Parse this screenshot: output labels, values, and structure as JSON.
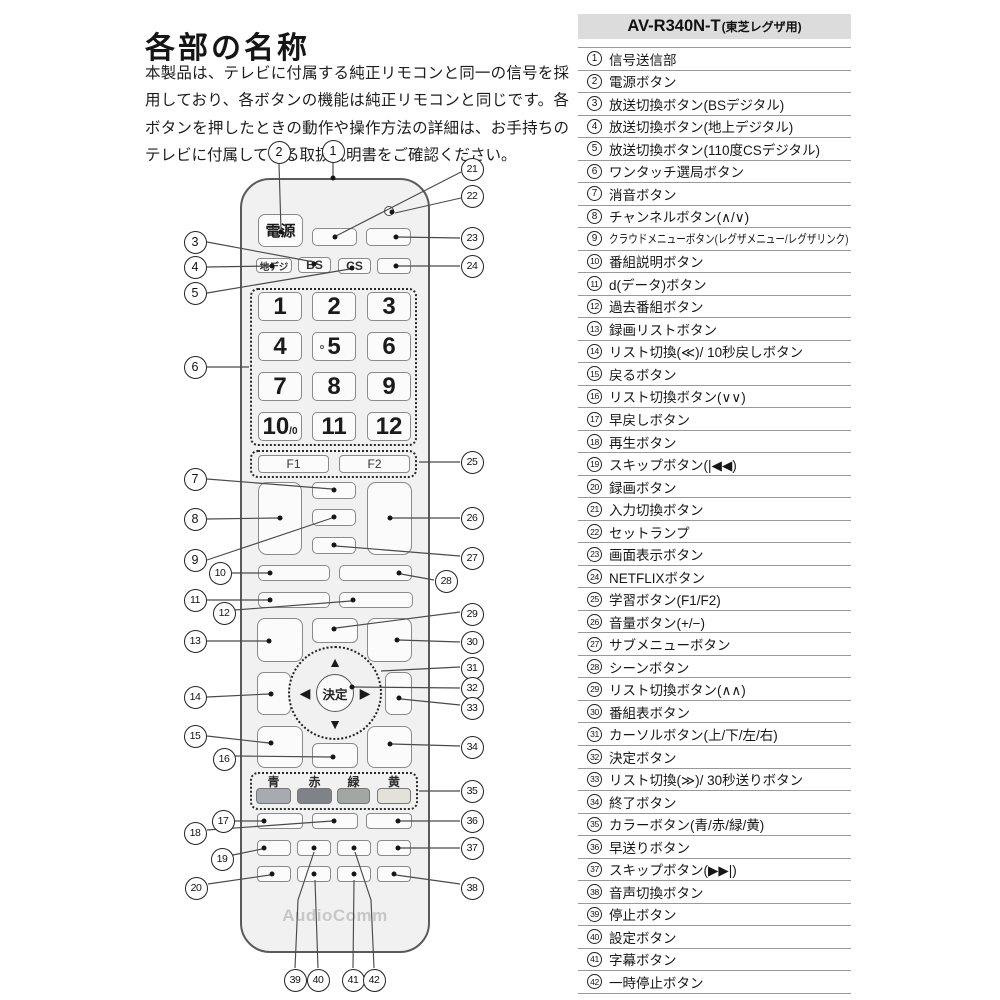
{
  "page": {
    "title": "各部の名称",
    "description": "本製品は、テレビに付属する純正リモコンと同一の信号を採用しており、各ボタンの機能は純正リモコンと同じです。各ボタンを押したときの動作や操作方法の詳細は、お手持ちのテレビに付属している取扱説明書をご確認ください。"
  },
  "parts_table": {
    "model": "AV-R340N-T",
    "model_suffix": "(東芝レグザ用)",
    "rows": [
      {
        "no": "1",
        "label": "信号送信部"
      },
      {
        "no": "2",
        "label": "電源ボタン"
      },
      {
        "no": "3",
        "label": "放送切換ボタン(BSデジタル)"
      },
      {
        "no": "4",
        "label": "放送切換ボタン(地上デジタル)"
      },
      {
        "no": "5",
        "label": "放送切換ボタン(110度CSデジタル)"
      },
      {
        "no": "6",
        "label": "ワンタッチ選局ボタン"
      },
      {
        "no": "7",
        "label": "消音ボタン"
      },
      {
        "no": "8",
        "label": "チャンネルボタン(∧/∨)"
      },
      {
        "no": "9",
        "label": "クラウドメニューボタン(レグザメニュー/レグザリンク)"
      },
      {
        "no": "10",
        "label": "番組説明ボタン"
      },
      {
        "no": "11",
        "label": "d(データ)ボタン"
      },
      {
        "no": "12",
        "label": "過去番組ボタン"
      },
      {
        "no": "13",
        "label": "録画リストボタン"
      },
      {
        "no": "14",
        "label": "リスト切換(≪)/ 10秒戻しボタン"
      },
      {
        "no": "15",
        "label": "戻るボタン"
      },
      {
        "no": "16",
        "label": "リスト切換ボタン(∨∨)"
      },
      {
        "no": "17",
        "label": "早戻しボタン"
      },
      {
        "no": "18",
        "label": "再生ボタン"
      },
      {
        "no": "19",
        "label": "スキップボタン(|◀◀)"
      },
      {
        "no": "20",
        "label": "録画ボタン"
      },
      {
        "no": "21",
        "label": "入力切換ボタン"
      },
      {
        "no": "22",
        "label": "セットランプ"
      },
      {
        "no": "23",
        "label": "画面表示ボタン"
      },
      {
        "no": "24",
        "label": "NETFLIXボタン"
      },
      {
        "no": "25",
        "label": "学習ボタン(F1/F2)"
      },
      {
        "no": "26",
        "label": "音量ボタン(+/−)"
      },
      {
        "no": "27",
        "label": "サブメニューボタン"
      },
      {
        "no": "28",
        "label": "シーンボタン"
      },
      {
        "no": "29",
        "label": "リスト切換ボタン(∧∧)"
      },
      {
        "no": "30",
        "label": "番組表ボタン"
      },
      {
        "no": "31",
        "label": "カーソルボタン(上/下/左/右)"
      },
      {
        "no": "32",
        "label": "決定ボタン"
      },
      {
        "no": "33",
        "label": "リスト切換(≫)/ 30秒送りボタン"
      },
      {
        "no": "34",
        "label": "終了ボタン"
      },
      {
        "no": "35",
        "label": "カラーボタン(青/赤/緑/黄)"
      },
      {
        "no": "36",
        "label": "早送りボタン"
      },
      {
        "no": "37",
        "label": "スキップボタン(▶▶|)"
      },
      {
        "no": "38",
        "label": "音声切換ボタン"
      },
      {
        "no": "39",
        "label": "停止ボタン"
      },
      {
        "no": "40",
        "label": "設定ボタン"
      },
      {
        "no": "41",
        "label": "字幕ボタン"
      },
      {
        "no": "42",
        "label": "一時停止ボタン"
      }
    ]
  },
  "remote": {
    "brand": "AudioComm",
    "power": "電源",
    "source_buttons": [
      "地デジ",
      "BS",
      "CS"
    ],
    "digits": [
      "1",
      "2",
      "3",
      "4",
      "5",
      "6",
      "7",
      "8",
      "9",
      "10",
      "11",
      "12"
    ],
    "digit10_suffix": "/0",
    "f_buttons": [
      "F1",
      "F2"
    ],
    "ok": "決定",
    "arrows": [
      "▲",
      "▼",
      "◀",
      "▶"
    ],
    "color_buttons": [
      {
        "label": "青",
        "color": "#a7abaf"
      },
      {
        "label": "赤",
        "color": "#7f8387"
      },
      {
        "label": "緑",
        "color": "#a2a7a3"
      },
      {
        "label": "黄",
        "color": "#e2e2da"
      }
    ]
  }
}
